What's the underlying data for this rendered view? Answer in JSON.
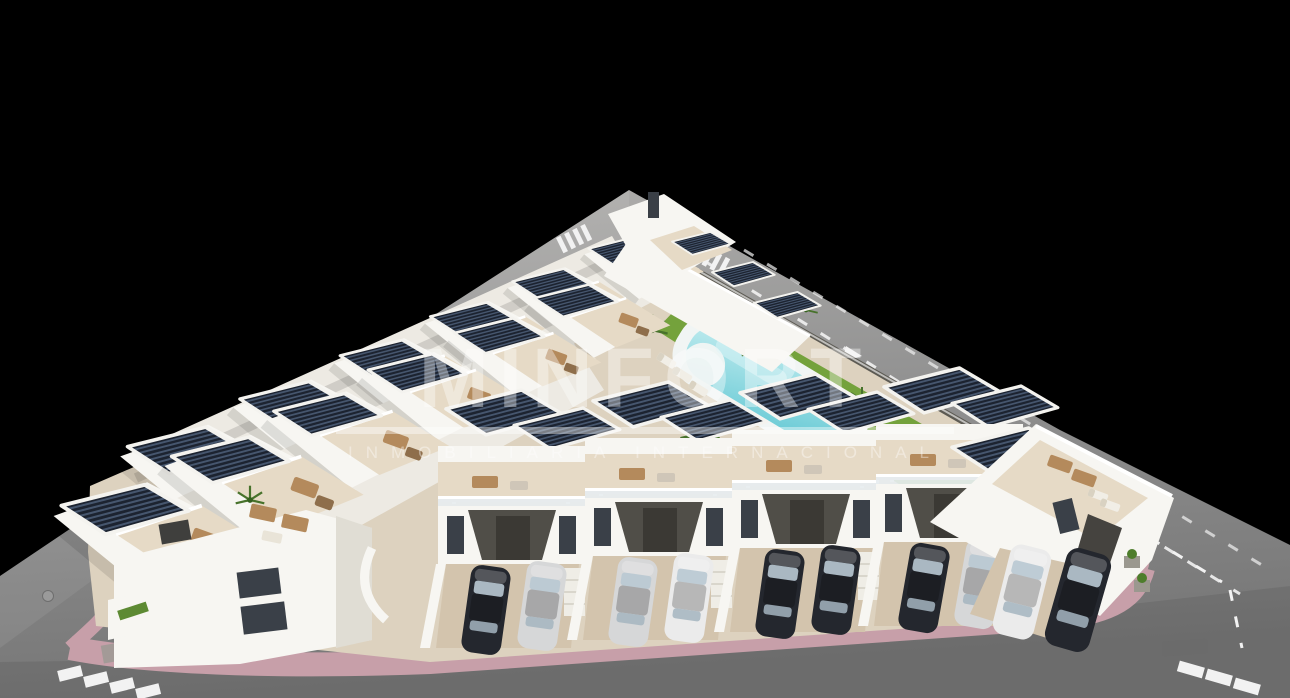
{
  "image": {
    "alt": "Aerial 3D architectural render of a modern white residential development with rooftop solar pergolas, roof terraces, communal lawn with swimming pool, pink sidewalks, crosswalks and street parking, on a black background"
  },
  "watermark": {
    "title": "MINFORT",
    "subtitle": "INMOBILIARIA INTERNACIONAL"
  },
  "colors": {
    "background": "#000000",
    "road": "#8f8f8f",
    "road_light": "#a9a9a9",
    "road_dark": "#757575",
    "marking_white": "#f2f2f2",
    "sidewalk_pink": "#c79fa9",
    "boundary_wall": "#57544c",
    "parcel_paving": "#ddd2bf",
    "building_white": "#f7f6f2",
    "building_mass": "#edeae3",
    "terrace_beige": "#d8c8b1",
    "terrace_light": "#e6dac6",
    "driveway": "#d3c4ad",
    "porch_dark": "#504e48",
    "window_dark": "#3a4048",
    "solar_panel": "#1c2330",
    "solar_stripe": "#46566e",
    "lawn_green": "#74a23c",
    "pool_turquoise": "#7ed2da",
    "pool_deck": "#f1f5f4",
    "furniture_wicker": "#b48a5c",
    "car_dark": "#24272e",
    "car_silver": "#d6d7d8",
    "car_white": "#ebebeb",
    "watermark_white": "#ffffff"
  }
}
